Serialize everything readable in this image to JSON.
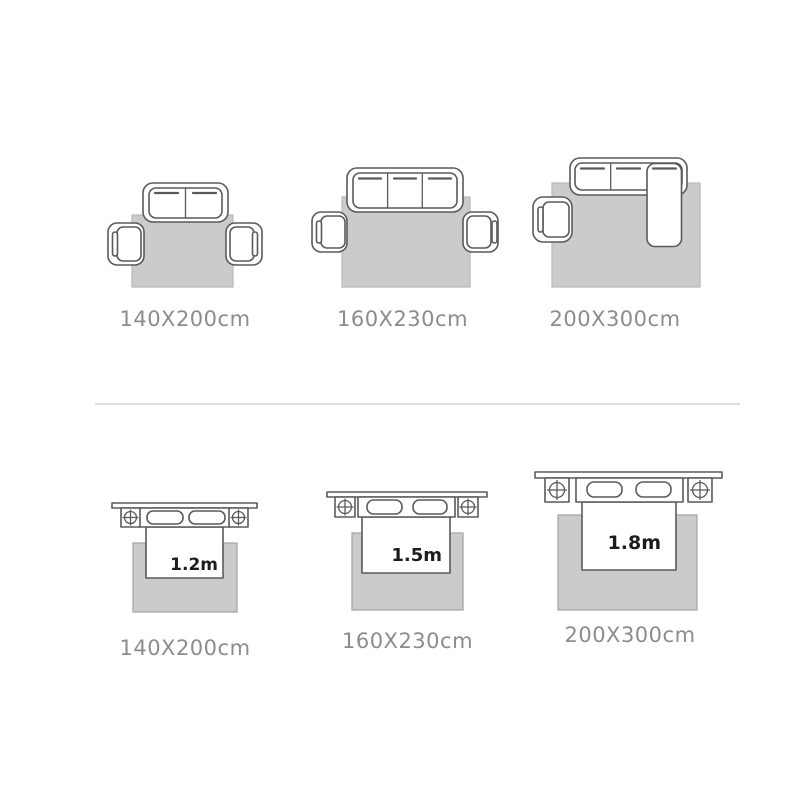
{
  "sofa_section": {
    "figures": [
      {
        "label": "140X200cm"
      },
      {
        "label": "160X230cm"
      },
      {
        "label": "200X300cm"
      }
    ]
  },
  "bed_section": {
    "figures": [
      {
        "label": "140X200cm",
        "bed_size": "1.2m"
      },
      {
        "label": "160X230cm",
        "bed_size": "1.5m"
      },
      {
        "label": "200X300cm",
        "bed_size": "1.8m"
      }
    ]
  },
  "colors": {
    "background": "#ffffff",
    "rug_fill": "#cbcbcb",
    "rug_border": "#aaaaaa",
    "furniture_outline": "#5a5a5a",
    "size_label_text": "#8c8c8c",
    "bed_size_text": "#1c1c1c",
    "divider": "#dedede"
  }
}
